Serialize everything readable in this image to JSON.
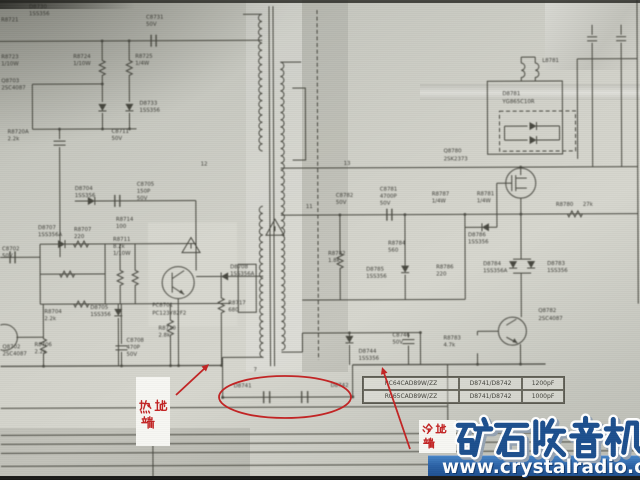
{
  "annotations": {
    "hot_label": "热地端",
    "cold_label": "冷地端"
  },
  "watermark": {
    "title": "矿石收音机",
    "url": "www.crystalradio.cn"
  },
  "parts_table": {
    "rows": [
      {
        "model": "RC64CAD89W/ZZ",
        "refs": "D8741/D8742",
        "value": "1200pF"
      },
      {
        "model": "RC65CAD89W/ZZ",
        "refs": "D8741/D8742",
        "value": "1000pF"
      }
    ]
  },
  "colors": {
    "annotation_red": "#c32424",
    "watermark_blue": "#1d4f8e",
    "bar_blue": "#2b62a6",
    "paper": "#cdcec6",
    "ink": "#3c3c34"
  },
  "schematic": {
    "labels": [
      {
        "x": 30,
        "y": 7,
        "t": "D8730"
      },
      {
        "x": 30,
        "y": 14,
        "t": "1SS356"
      },
      {
        "x": 147,
        "y": 18,
        "t": "C8731"
      },
      {
        "x": 147,
        "y": 25,
        "t": "50V"
      },
      {
        "x": 2,
        "y": 20,
        "t": "R8721"
      },
      {
        "x": 2,
        "y": 57,
        "t": "R8723"
      },
      {
        "x": 2,
        "y": 64,
        "t": "1/10W"
      },
      {
        "x": 2,
        "y": 81,
        "t": "Q8703"
      },
      {
        "x": 2,
        "y": 88,
        "t": "2SC4087"
      },
      {
        "x": 74,
        "y": 57,
        "t": "R8724"
      },
      {
        "x": 74,
        "y": 64,
        "t": "1/10W"
      },
      {
        "x": 136,
        "y": 57,
        "t": "R8725"
      },
      {
        "x": 136,
        "y": 64,
        "t": "1/4W"
      },
      {
        "x": 140,
        "y": 104,
        "t": "D8733"
      },
      {
        "x": 140,
        "y": 111,
        "t": "1SS356"
      },
      {
        "x": 8,
        "y": 132,
        "t": "R8720A"
      },
      {
        "x": 8,
        "y": 139,
        "t": "2.2k"
      },
      {
        "x": 112,
        "y": 132,
        "t": "C8711"
      },
      {
        "x": 112,
        "y": 139,
        "t": "50V"
      },
      {
        "x": 2,
        "y": 249,
        "t": "C8702"
      },
      {
        "x": 2,
        "y": 256,
        "t": "50V"
      },
      {
        "x": 75,
        "y": 189,
        "t": "D8704"
      },
      {
        "x": 75,
        "y": 196,
        "t": "1SS356"
      },
      {
        "x": 137,
        "y": 185,
        "t": "C8705"
      },
      {
        "x": 137,
        "y": 192,
        "t": "150P"
      },
      {
        "x": 137,
        "y": 199,
        "t": "50V"
      },
      {
        "x": 116,
        "y": 220,
        "t": "R8714"
      },
      {
        "x": 116,
        "y": 227,
        "t": "100"
      },
      {
        "x": 38,
        "y": 228,
        "t": "D8707"
      },
      {
        "x": 38,
        "y": 235,
        "t": "1SS356A"
      },
      {
        "x": 74,
        "y": 230,
        "t": "R8707"
      },
      {
        "x": 74,
        "y": 237,
        "t": "220"
      },
      {
        "x": 113,
        "y": 240,
        "t": "R8711"
      },
      {
        "x": 113,
        "y": 247,
        "t": "8.2k"
      },
      {
        "x": 113,
        "y": 254,
        "t": "1/10W"
      },
      {
        "x": 44,
        "y": 312,
        "t": "R8704"
      },
      {
        "x": 44,
        "y": 319,
        "t": "2.2k"
      },
      {
        "x": 90,
        "y": 308,
        "t": "D8705"
      },
      {
        "x": 90,
        "y": 315,
        "t": "1SS356"
      },
      {
        "x": 152,
        "y": 306,
        "t": "PC8701"
      },
      {
        "x": 152,
        "y": 314,
        "t": "PC123Y82F2"
      },
      {
        "x": 228,
        "y": 304,
        "t": "R8717"
      },
      {
        "x": 228,
        "y": 311,
        "t": "680"
      },
      {
        "x": 230,
        "y": 268,
        "t": "D8708"
      },
      {
        "x": 230,
        "y": 275,
        "t": "1SS356A"
      },
      {
        "x": 2,
        "y": 347,
        "t": "Q8702"
      },
      {
        "x": 2,
        "y": 354,
        "t": "2SC4087"
      },
      {
        "x": 34,
        "y": 345,
        "t": "R8706"
      },
      {
        "x": 34,
        "y": 352,
        "t": "2.2k"
      },
      {
        "x": 126,
        "y": 341,
        "t": "C8708"
      },
      {
        "x": 126,
        "y": 348,
        "t": "470P"
      },
      {
        "x": 126,
        "y": 355,
        "t": "50V"
      },
      {
        "x": 158,
        "y": 329,
        "t": "R8710"
      },
      {
        "x": 158,
        "y": 336,
        "t": "2.8k"
      },
      {
        "x": 201,
        "y": 165,
        "t": "12",
        "s": 4.6
      },
      {
        "x": 344,
        "y": 165,
        "t": "13",
        "s": 4.6
      },
      {
        "x": 306,
        "y": 208,
        "t": "11",
        "s": 4.6
      },
      {
        "x": 253,
        "y": 371,
        "t": "7",
        "s": 4.6
      },
      {
        "x": 233,
        "y": 387,
        "t": "D8741"
      },
      {
        "x": 330,
        "y": 387,
        "t": "D8742"
      },
      {
        "x": 444,
        "y": 153,
        "t": "Q8780"
      },
      {
        "x": 444,
        "y": 161,
        "t": "2SK2373"
      },
      {
        "x": 503,
        "y": 96,
        "t": "D8781"
      },
      {
        "x": 503,
        "y": 104,
        "t": "YG865C10R"
      },
      {
        "x": 543,
        "y": 63,
        "t": "L8781"
      },
      {
        "x": 432,
        "y": 196,
        "t": "R8787"
      },
      {
        "x": 432,
        "y": 203,
        "t": "1/4W"
      },
      {
        "x": 477,
        "y": 196,
        "t": "R8781"
      },
      {
        "x": 477,
        "y": 203,
        "t": "1/4W"
      },
      {
        "x": 556,
        "y": 207,
        "t": "R8780"
      },
      {
        "x": 583,
        "y": 207,
        "t": "27k"
      },
      {
        "x": 468,
        "y": 237,
        "t": "D8786"
      },
      {
        "x": 468,
        "y": 244,
        "t": "1SS356"
      },
      {
        "x": 336,
        "y": 197,
        "t": "C8782"
      },
      {
        "x": 336,
        "y": 204,
        "t": "50V"
      },
      {
        "x": 380,
        "y": 191,
        "t": "C8781"
      },
      {
        "x": 380,
        "y": 198,
        "t": "4700P"
      },
      {
        "x": 380,
        "y": 205,
        "t": "50V"
      },
      {
        "x": 328,
        "y": 255,
        "t": "R8782"
      },
      {
        "x": 328,
        "y": 262,
        "t": "1.8k"
      },
      {
        "x": 388,
        "y": 245,
        "t": "R8784"
      },
      {
        "x": 388,
        "y": 252,
        "t": "560"
      },
      {
        "x": 366,
        "y": 271,
        "t": "D8785"
      },
      {
        "x": 366,
        "y": 278,
        "t": "1SS356"
      },
      {
        "x": 436,
        "y": 269,
        "t": "R8786"
      },
      {
        "x": 436,
        "y": 276,
        "t": "220"
      },
      {
        "x": 483,
        "y": 266,
        "t": "D8784"
      },
      {
        "x": 483,
        "y": 273,
        "t": "1SS356A"
      },
      {
        "x": 547,
        "y": 266,
        "t": "D8783"
      },
      {
        "x": 547,
        "y": 273,
        "t": "1SS356"
      },
      {
        "x": 538,
        "y": 313,
        "t": "Q8782"
      },
      {
        "x": 538,
        "y": 321,
        "t": "2SC4087"
      },
      {
        "x": 443,
        "y": 340,
        "t": "R8783"
      },
      {
        "x": 443,
        "y": 347,
        "t": "4.7k"
      },
      {
        "x": 358,
        "y": 353,
        "t": "D8744"
      },
      {
        "x": 358,
        "y": 360,
        "t": "1SS356"
      },
      {
        "x": 392,
        "y": 337,
        "t": "C8746"
      },
      {
        "x": 392,
        "y": 344,
        "t": "50V"
      }
    ]
  }
}
